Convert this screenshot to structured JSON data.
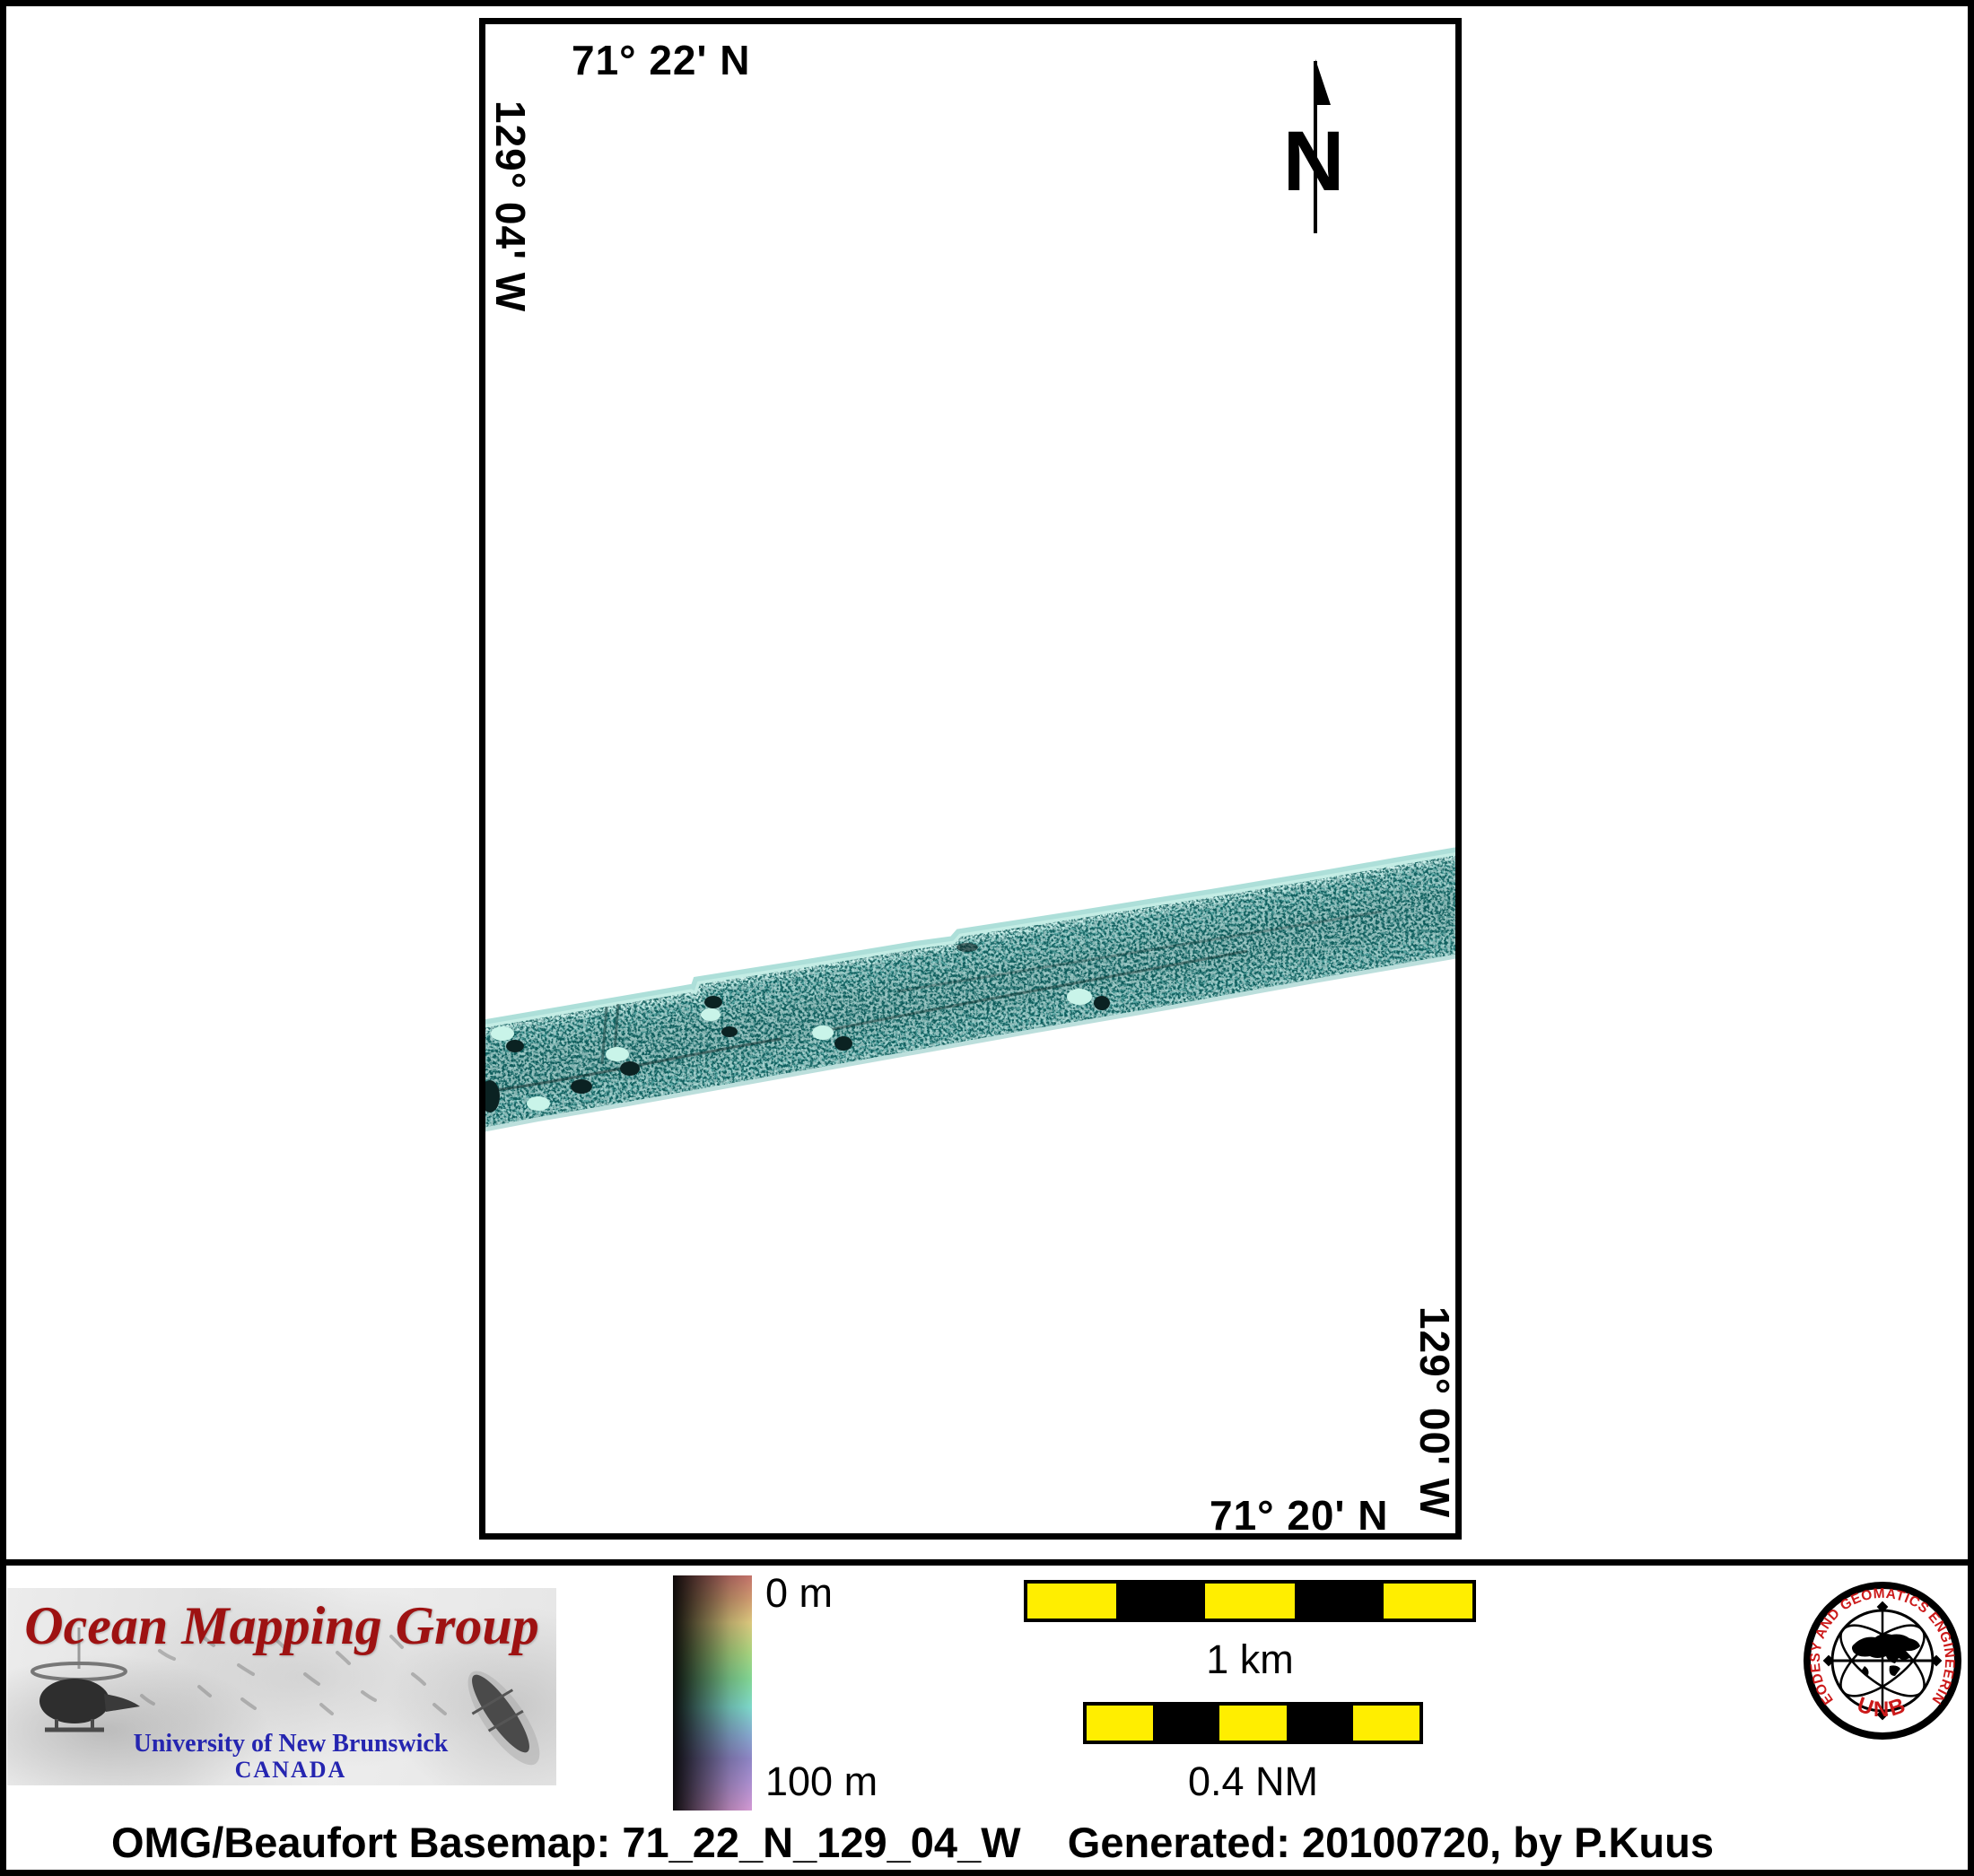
{
  "map": {
    "top_coordinate": "71° 22' N",
    "left_coordinate": "129° 04' W",
    "right_coordinate": "129° 00' W",
    "bottom_coordinate": "71° 20' N",
    "north_arrow_label": "N",
    "swath_color_mid": "#55a3a0",
    "swath_color_light": "#c9f4e9",
    "swath_color_dark": "#0b2222"
  },
  "legend": {
    "depth_scale": {
      "top_label": "0 m",
      "bottom_label": "100 m"
    },
    "scale_bar_km": {
      "label": "1 km"
    },
    "scale_bar_nm": {
      "label": "0.4 NM"
    },
    "bar_yellow": "#ffee00",
    "bar_black": "#000000"
  },
  "omg_logo": {
    "title": "Ocean Mapping Group",
    "university": "University of New Brunswick",
    "country": "CANADA",
    "title_color": "#9e1212",
    "text_blue": "#2525b0"
  },
  "unb_seal": {
    "ring_text": "GEODESY AND GEOMATICS ENGINEERING",
    "acronym": "UNB",
    "red": "#cc1a1a"
  },
  "footer": {
    "caption": "OMG/Beaufort Basemap: 71_22_N_129_04_W    Generated: 20100720, by P.Kuus"
  }
}
